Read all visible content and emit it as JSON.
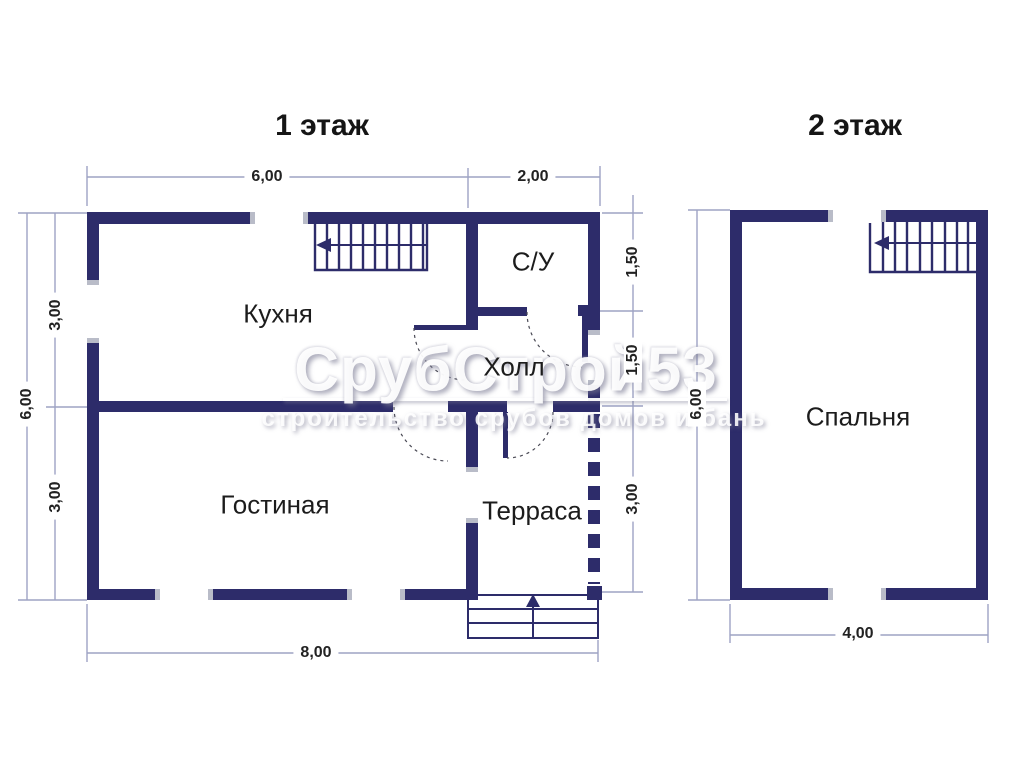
{
  "titles": {
    "floor1": "1 этаж",
    "floor2": "2 этаж"
  },
  "floor1": {
    "rooms": {
      "kitchen": "Кухня",
      "bathroom": "С/У",
      "hall": "Холл",
      "living": "Гостиная",
      "terrace": "Терраса"
    },
    "dims": {
      "top_left": "6,00",
      "top_right": "2,00",
      "left_total": "6,00",
      "left_upper": "3,00",
      "left_lower": "3,00",
      "right_upper": "1,50",
      "right_middle": "1,50",
      "right_lower": "3,00",
      "bottom": "8,00"
    }
  },
  "floor2": {
    "rooms": {
      "bedroom": "Спальня"
    },
    "dims": {
      "left": "6,00",
      "bottom": "4,00"
    }
  },
  "watermark": {
    "title": "СрубСтрой53",
    "subtitle": "строительство срубов домов и бань"
  },
  "colors": {
    "wall": "#2d2c6a",
    "dimension_line": "#9ea3c4",
    "label_text": "#1c1c1c",
    "watermark": "#ffffff"
  }
}
